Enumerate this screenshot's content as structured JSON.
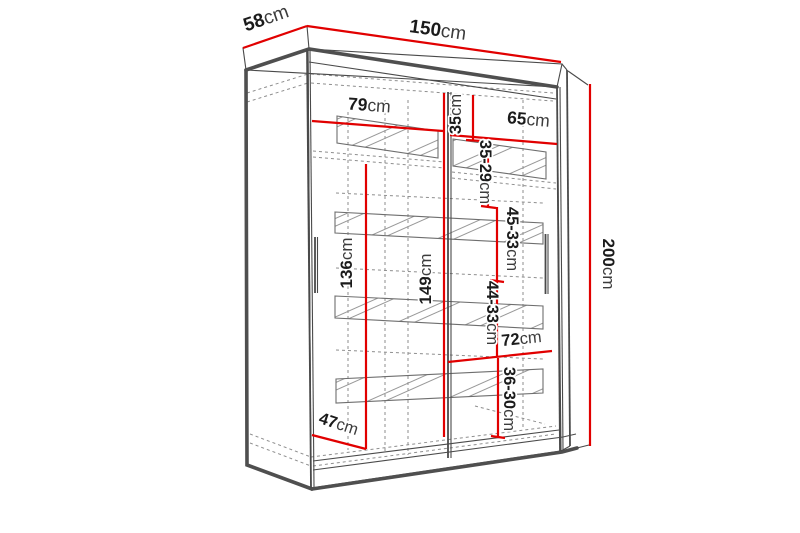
{
  "diagram": {
    "kind": "wardrobe-dimension-technical-drawing",
    "unit": "cm",
    "accent_color": "#e10000",
    "line_color": "#4a4a4a",
    "labels": {
      "depth_top": {
        "value": "58",
        "unit": "cm"
      },
      "width_top": {
        "value": "150",
        "unit": "cm"
      },
      "height_right": {
        "value": "200",
        "unit": "cm"
      },
      "left_section_width": {
        "value": "79",
        "unit": "cm"
      },
      "right_section_width": {
        "value": "65",
        "unit": "cm"
      },
      "right_gap_top": {
        "value": "35",
        "unit": "cm"
      },
      "right_gap_second": {
        "value": "35-29",
        "unit": "cm"
      },
      "right_gap_third": {
        "value": "45-33",
        "unit": "cm"
      },
      "right_gap_fourth": {
        "value": "44-33",
        "unit": "cm"
      },
      "right_gap_fifth": {
        "value": "36-30",
        "unit": "cm"
      },
      "left_hanging_height": {
        "value": "136",
        "unit": "cm"
      },
      "center_interior_height": {
        "value": "149",
        "unit": "cm"
      },
      "bottom_right_section_width": {
        "value": "72",
        "unit": "cm"
      },
      "interior_floor_depth": {
        "value": "47",
        "unit": "cm"
      }
    }
  }
}
